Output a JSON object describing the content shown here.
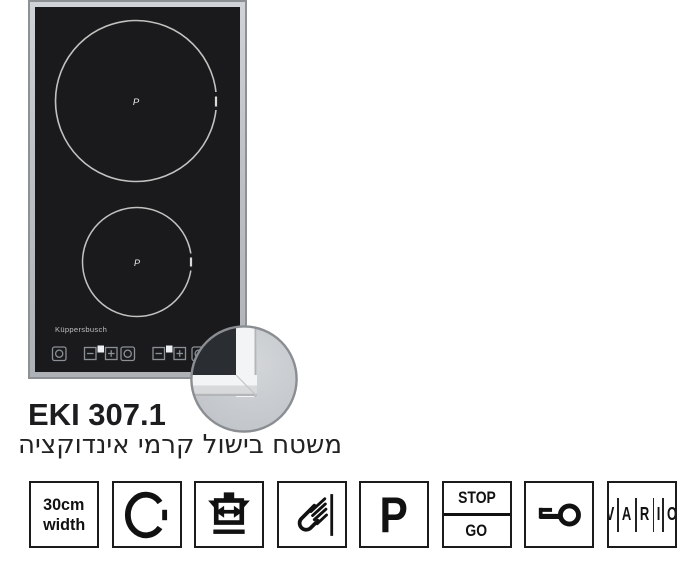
{
  "product": {
    "model": "EKI 307.1",
    "description_he": "משטח בישול קרמי אינדוקציה",
    "brand": "Küppersbusch"
  },
  "cooktop": {
    "zone_labels": [
      "P",
      "P"
    ]
  },
  "features": [
    {
      "name": "30cm-width",
      "type": "text",
      "lines": [
        "30cm",
        "width"
      ]
    },
    {
      "name": "cooking-zone",
      "type": "icon",
      "icon": "zone-circle-icon"
    },
    {
      "name": "pan-size-recognition",
      "type": "icon",
      "icon": "pot-arrows-icon"
    },
    {
      "name": "sensor-touch-control",
      "type": "icon",
      "icon": "touch-hand-icon"
    },
    {
      "name": "power-boost",
      "type": "text",
      "label": "P"
    },
    {
      "name": "stop-and-go",
      "type": "text",
      "lines": [
        "STOP",
        "GO"
      ]
    },
    {
      "name": "child-lock",
      "type": "icon",
      "icon": "key-icon"
    },
    {
      "name": "vario",
      "type": "letters",
      "letters": [
        "V",
        "A",
        "R",
        "I",
        "O"
      ]
    }
  ],
  "colors": {
    "glass": "#1a1a1c",
    "frame": "#bfc3c7",
    "ink": "#1b1b1b",
    "circle_outline": "#d9d9d7"
  }
}
